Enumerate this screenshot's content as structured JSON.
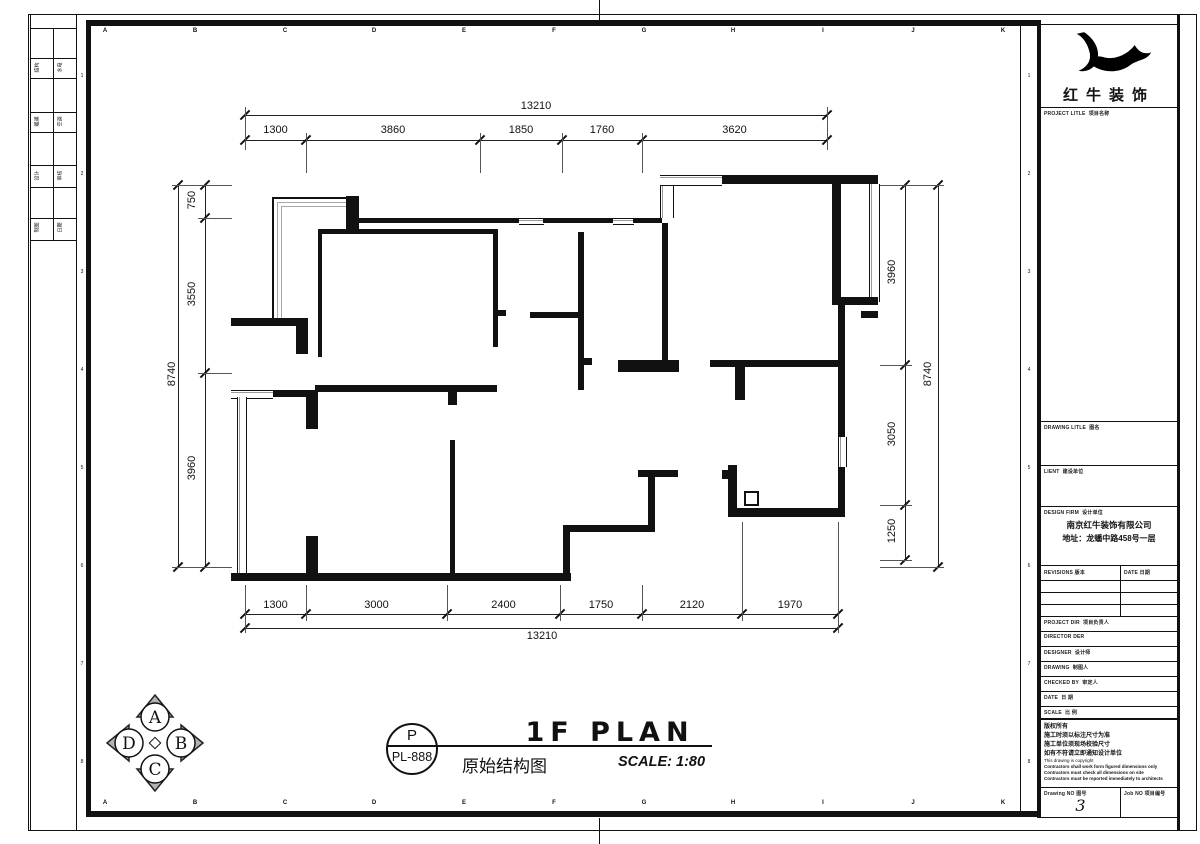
{
  "grid": {
    "letters": [
      "A",
      "B",
      "C",
      "D",
      "E",
      "F",
      "G",
      "H",
      "I",
      "J",
      "K"
    ],
    "numbers": [
      "1",
      "2",
      "3",
      "4",
      "5",
      "6",
      "7",
      "8"
    ]
  },
  "signoff": {
    "rows": [
      [
        "结构",
        "水电"
      ],
      [
        "暖通",
        "空调"
      ],
      [
        "设计",
        "审核"
      ],
      [
        "制图",
        "日期"
      ]
    ]
  },
  "dims": {
    "top_total": "13210",
    "top": [
      "1300",
      "3860",
      "1850",
      "1760",
      "3620"
    ],
    "bottom": [
      "1300",
      "3000",
      "2400",
      "1750",
      "2120",
      "1970"
    ],
    "bottom_total": "13210",
    "left_total": "8740",
    "left": [
      "750",
      "3550",
      "3960"
    ],
    "right": [
      "3960",
      "3050",
      "1250"
    ],
    "right_total": "8740"
  },
  "compass": {
    "n": "A",
    "e": "B",
    "s": "C",
    "w": "D"
  },
  "footer": {
    "stamp_top": "P",
    "stamp_bottom": "PL-888",
    "title_en": "1F PLAN",
    "title_cn": "原始结构图",
    "scale": "SCALE: 1:80"
  },
  "titleblock": {
    "brand": "红牛装饰",
    "project": {
      "en": "PROJECT LITLE",
      "cn": "项目名称"
    },
    "drawing_title": {
      "en": "DRAWING LITLE",
      "cn": "图名"
    },
    "client": {
      "en": "LIENT",
      "cn": "建设单位"
    },
    "design_firm": {
      "en": "DESIGN FIRM",
      "cn": "设计单位"
    },
    "firm_name": "南京红牛装饰有限公司",
    "firm_address": "地址：龙蟠中路458号一层",
    "revisions": {
      "en": "REVISIONS",
      "cn": "版本"
    },
    "date_col": {
      "en": "DATE",
      "cn": "日期"
    },
    "staff": [
      {
        "en": "PROJECT DIR",
        "cn": "项目负责人"
      },
      {
        "en": "DIRECTOR DER",
        "cn": ""
      },
      {
        "en": "DESIGNER",
        "cn": "设计师"
      },
      {
        "en": "DRAWING",
        "cn": "制图人"
      },
      {
        "en": "CHECKED BY",
        "cn": "审定人"
      },
      {
        "en": "DATE",
        "cn": "日 期"
      },
      {
        "en": "SCALE",
        "cn": "比 例"
      }
    ],
    "copyright": [
      "版权所有",
      "施工时须以标注尺寸为准",
      "施工单位须现场校验尺寸",
      "如有不符请立即通知设计单位",
      "This drawing is copyright",
      "Contractors shall work form figured dimensions only",
      "Contractors must check all dimensions on site",
      "Contractors must be reported immediately to architects",
      "版权所有"
    ],
    "drawing_no": {
      "en": "Drawing NO",
      "cn": "图号",
      "value": "3"
    },
    "job_no": {
      "en": "Job NO",
      "cn": "项目编号"
    }
  }
}
